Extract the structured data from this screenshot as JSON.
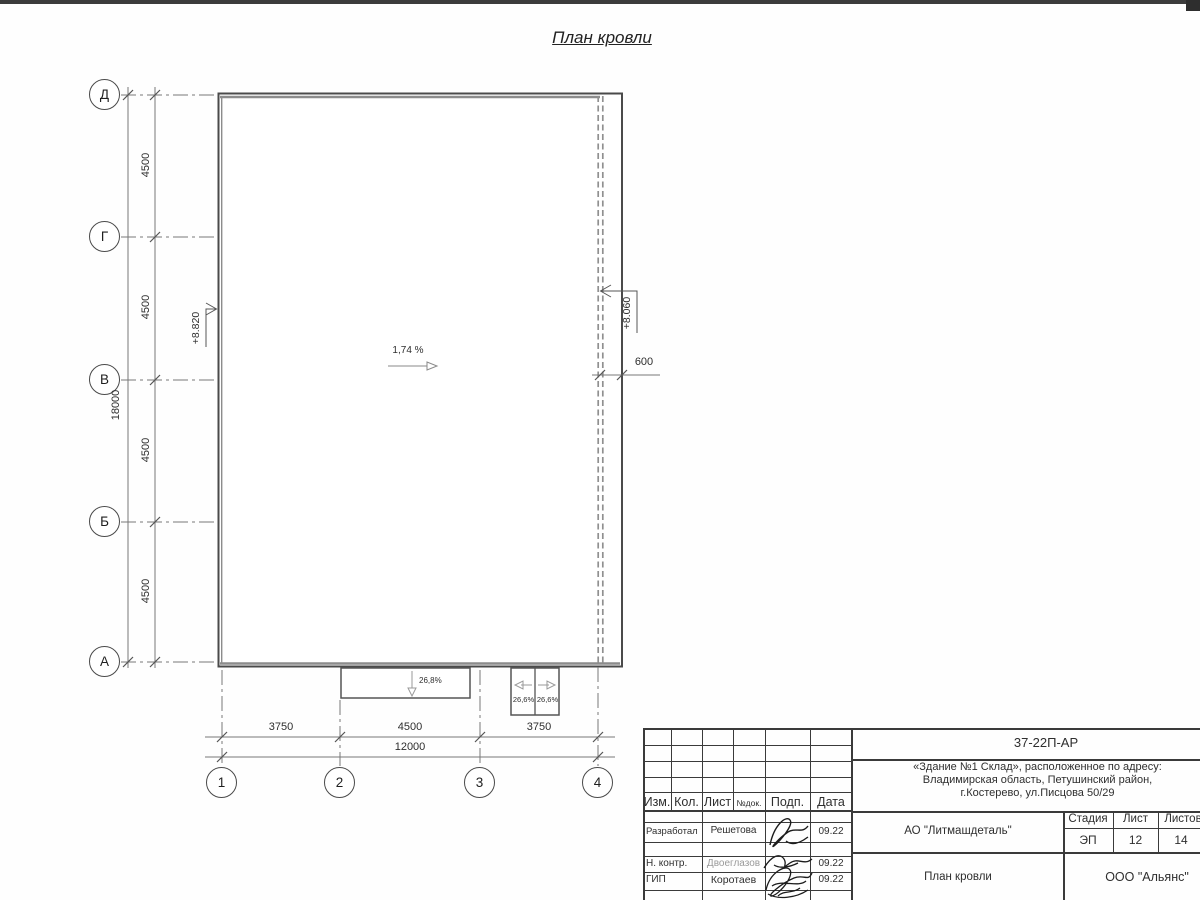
{
  "title": "План кровли",
  "colors": {
    "ink": "#3d3d3d",
    "line_grey": "#8a8a8a",
    "dash_grey": "#999999",
    "muted_name": "#9a9a9a"
  },
  "plan": {
    "slope_main": "1,74 %",
    "elevation_left": "+8.820",
    "elevation_right": "+8.060",
    "overhang_dim": "600",
    "canopy_slope": "26,8%",
    "ramp_slope_left": "26,6%",
    "ramp_slope_right": "26,6%",
    "row_axes": [
      "Д",
      "Г",
      "В",
      "Б",
      "А"
    ],
    "col_axes": [
      "1",
      "2",
      "3",
      "4"
    ],
    "row_spacing_dims": [
      "4500",
      "4500",
      "4500",
      "4500"
    ],
    "row_total_dim": "18000",
    "col_spacing_dims": [
      "3750",
      "4500",
      "3750"
    ],
    "col_total_dim": "12000"
  },
  "title_block": {
    "doc_number": "37-22П-АР",
    "project_address_lines": [
      "«Здание №1 Склад», расположенное по адресу:",
      "Владимирская область, Петушинский район,",
      "г.Костерево, ул.Писцова 50/29"
    ],
    "columns": {
      "izm": "Изм.",
      "kol": "Кол.",
      "list": "Лист",
      "ndok": "№док.",
      "podp": "Подп.",
      "data": "Дата"
    },
    "signature_rows": [
      {
        "role": "Разработал",
        "name": "Решетова",
        "date": "09.22"
      },
      {
        "role": "Н. контр.",
        "name": "Двоеглазов",
        "date": "09.22"
      },
      {
        "role": "ГИП",
        "name": "Коротаев",
        "date": "09.22"
      }
    ],
    "client": "АО \"Литмашдеталь\"",
    "stage_header": "Стадия",
    "sheet_header": "Лист",
    "sheets_header": "Листов",
    "stage": "ЭП",
    "sheet_number": "12",
    "sheets_total": "14",
    "sheet_title": "План кровли",
    "contractor": "ООО \"Альянс\""
  }
}
